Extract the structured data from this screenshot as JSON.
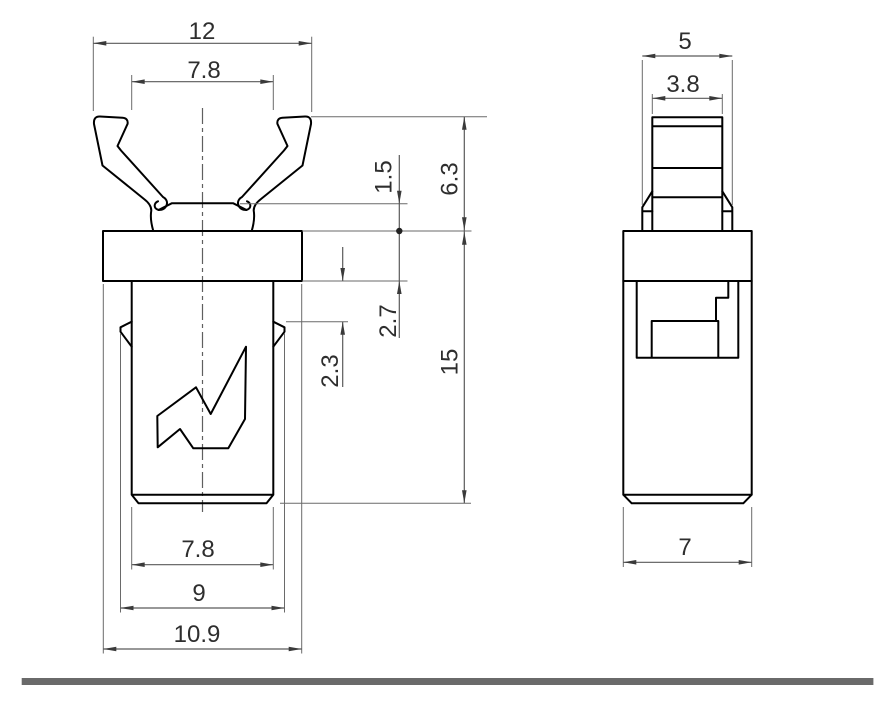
{
  "drawing": {
    "front_view": {
      "dims": {
        "overall_width": "12",
        "crown_tip_width": "7.8",
        "crown_seat_drop": "1.5",
        "crown_height": "6.3",
        "flange_thickness": "2.7",
        "barb_offset": "2.3",
        "body_length": "15",
        "body_width": "7.8",
        "barb_span": "9",
        "flange_width": "10.9"
      }
    },
    "side_view": {
      "dims": {
        "head_width": "5",
        "tab_width": "3.8",
        "body_depth": "7"
      }
    }
  }
}
